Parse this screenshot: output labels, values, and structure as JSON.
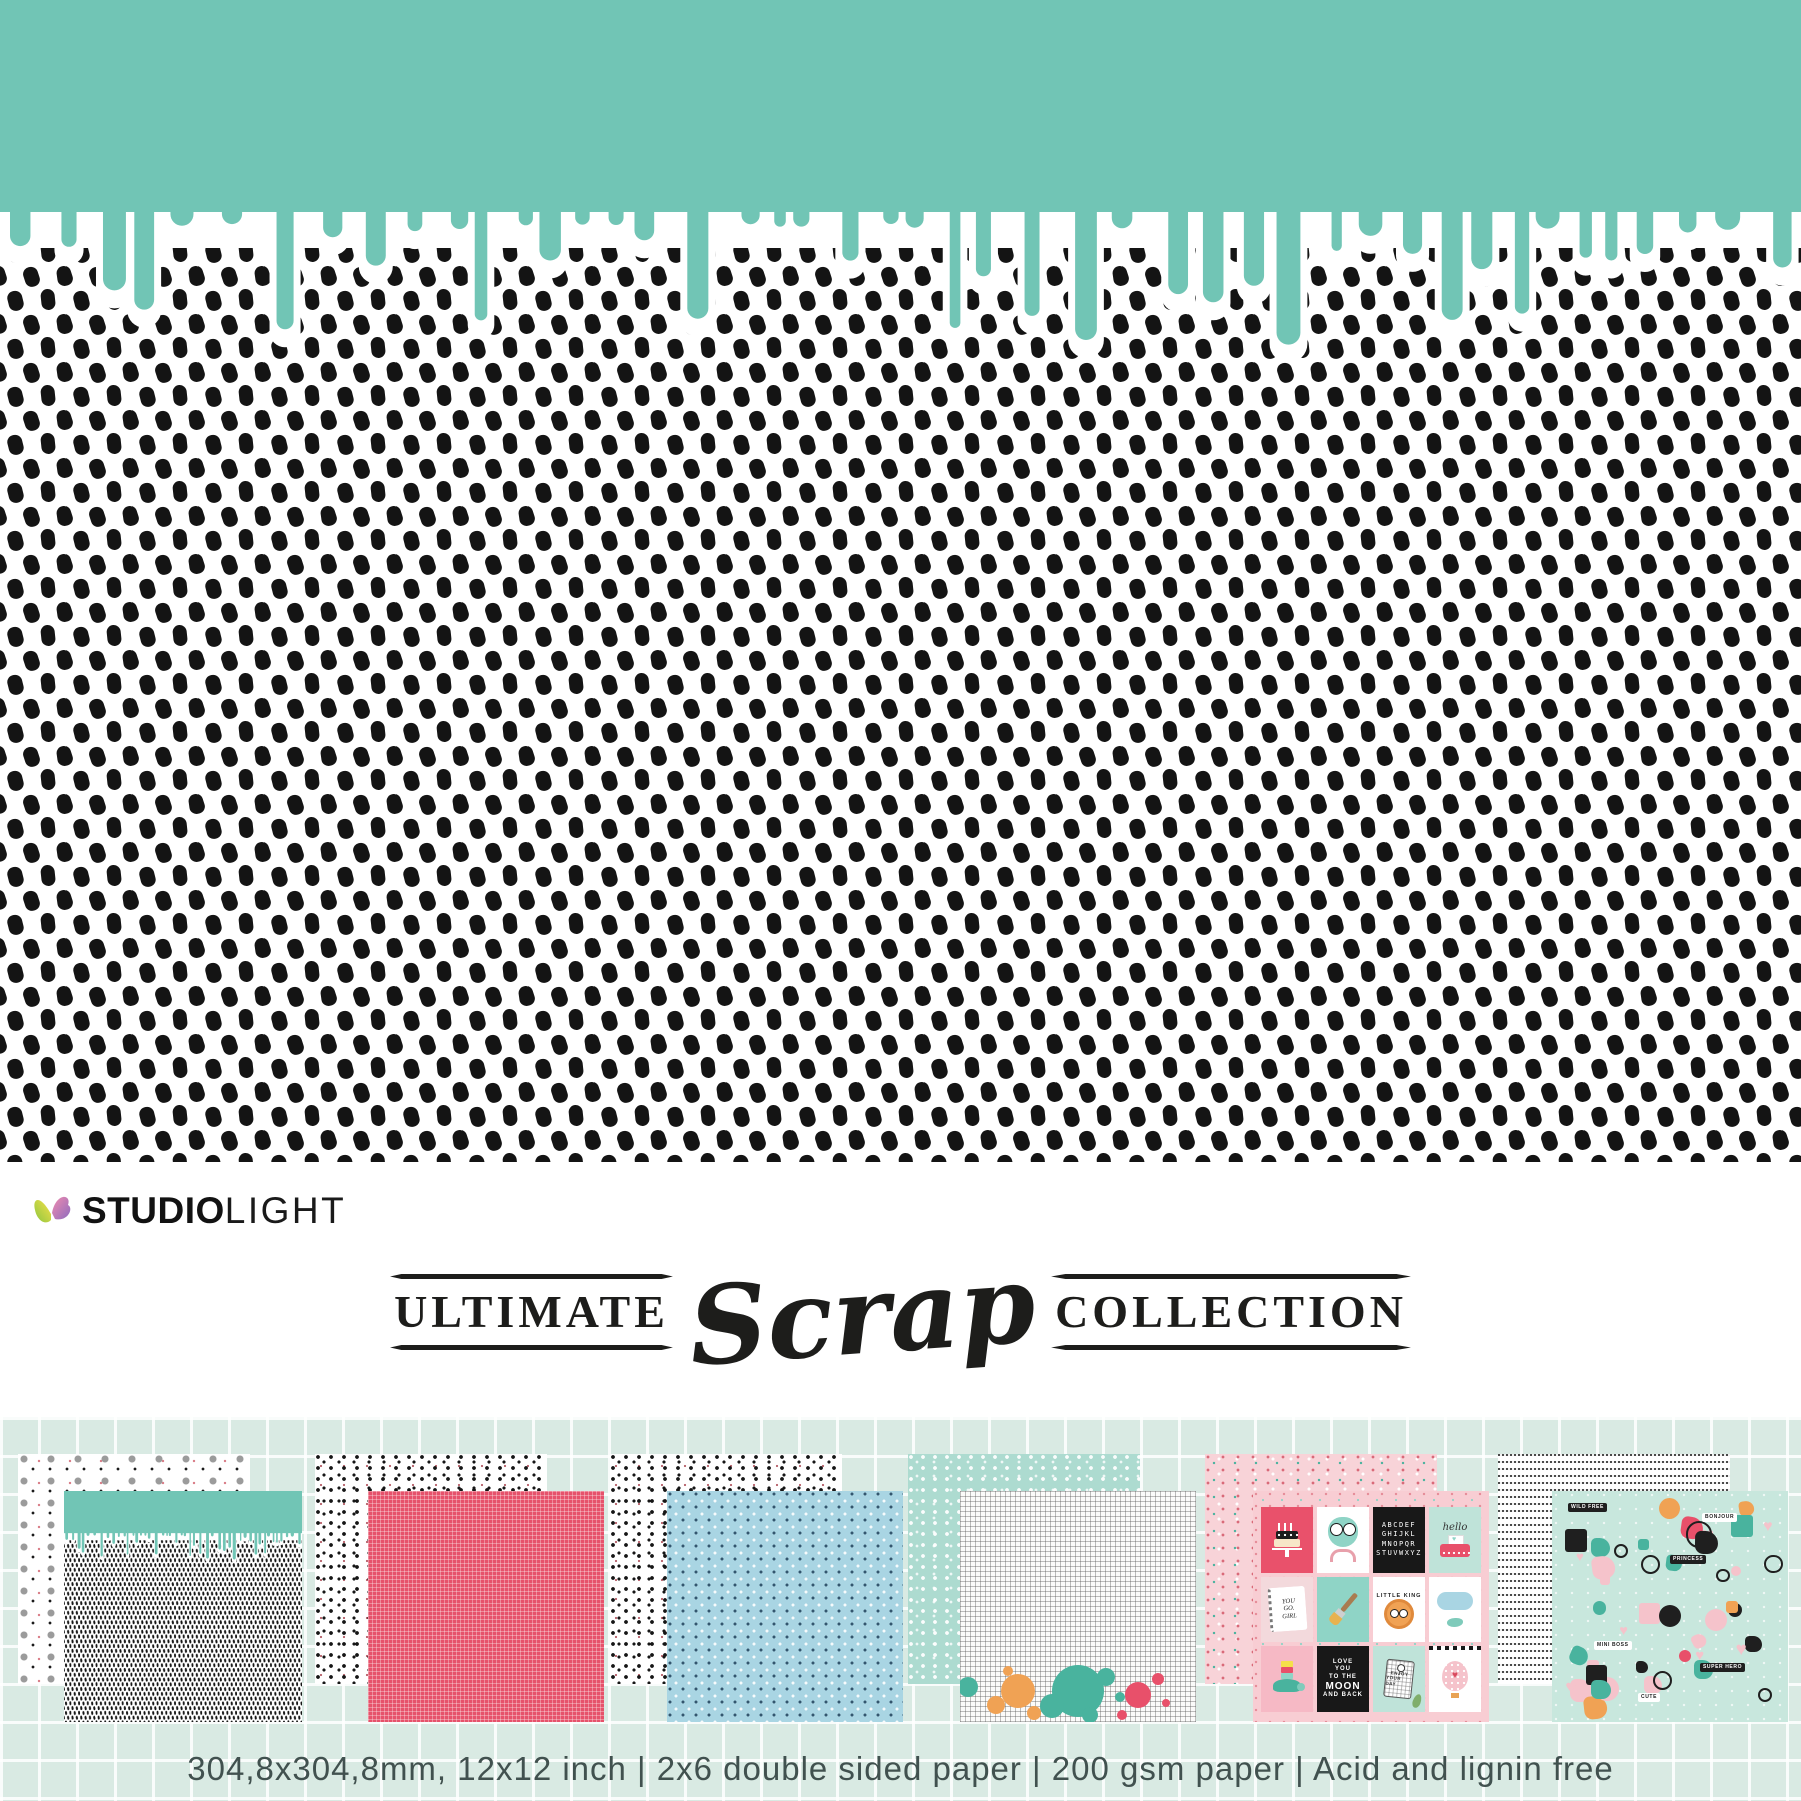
{
  "brand": {
    "bold": "STUDIO",
    "light": "LIGHT"
  },
  "title": {
    "left": "ULTIMATE",
    "script": "Scrap",
    "right": "COLLECTION"
  },
  "footer": {
    "specs": "304,8x304,8mm, 12x12 inch | 2x6 double sided paper | 200 gsm paper | Acid and lignin free"
  },
  "colors": {
    "teal": "#71c5b5",
    "mint_background": "#d9eae3",
    "red_sheet": "#e6526b",
    "blue_sheet": "#a9d5e3",
    "mint_sheet": "#addbd0",
    "pink_sheet": "#f8d3d8",
    "sticker_sheet": "#c8e7dd",
    "ink": "#1d1d1b",
    "spec_text": "#41514f"
  },
  "cards": {
    "alphabet_lines": [
      "ABCDEF",
      "GHIJKL",
      "MNOPQR",
      "STUVWXYZ"
    ],
    "hello": "hello",
    "you_go_girl": [
      "YOU",
      "GO.",
      "GIRL"
    ],
    "little_king": "LITTLE KING",
    "love_moon": [
      "LOVE",
      "YOU",
      "TO THE",
      "MOON",
      "AND BACK"
    ],
    "enjoy": [
      "ENJOY",
      "YOUR DAY"
    ]
  },
  "stickers": [
    {
      "label": "WILD FREE"
    },
    {
      "label": "BONJOUR"
    },
    {
      "label": "PRINCESS"
    },
    {
      "label": "MINI BOSS"
    },
    {
      "label": "SUPER HERO"
    },
    {
      "label": "CUTE"
    }
  ]
}
